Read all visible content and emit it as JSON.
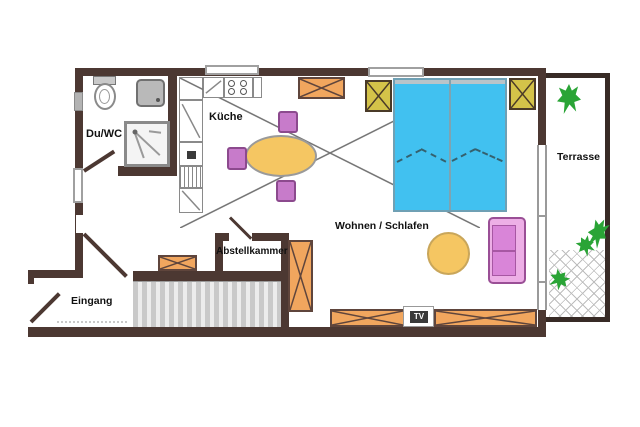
{
  "plan": {
    "rooms": {
      "bathroom": "Du/WC",
      "kitchen": "Küche",
      "living": "Wohnen / Schlafen",
      "storage": "Abstellkammer",
      "entrance": "Eingang",
      "terrace": "Terrasse"
    },
    "tv_label": "TV",
    "colors": {
      "wall": "#4c3832",
      "terrace_wall": "#382b26",
      "bed_fill": "#41c1f0",
      "wood_orange": "#f1a65e",
      "nightstand_yellow": "#d4c349",
      "chair_purple": "#c77bca",
      "sofa_pink": "#d985d8",
      "table_yellow": "#f5c662",
      "plant_green": "#2aa436",
      "stairs_gray": "#d9d9d9"
    },
    "furniture_icons": [
      "double-bed",
      "nightstand",
      "dresser",
      "wardrobe",
      "bench",
      "tv-sideboard",
      "tv",
      "dining-table",
      "chair",
      "sofa",
      "round-rug",
      "stairs",
      "toilet",
      "washbasin",
      "shower",
      "stove",
      "oven",
      "dishwasher",
      "plants"
    ]
  }
}
